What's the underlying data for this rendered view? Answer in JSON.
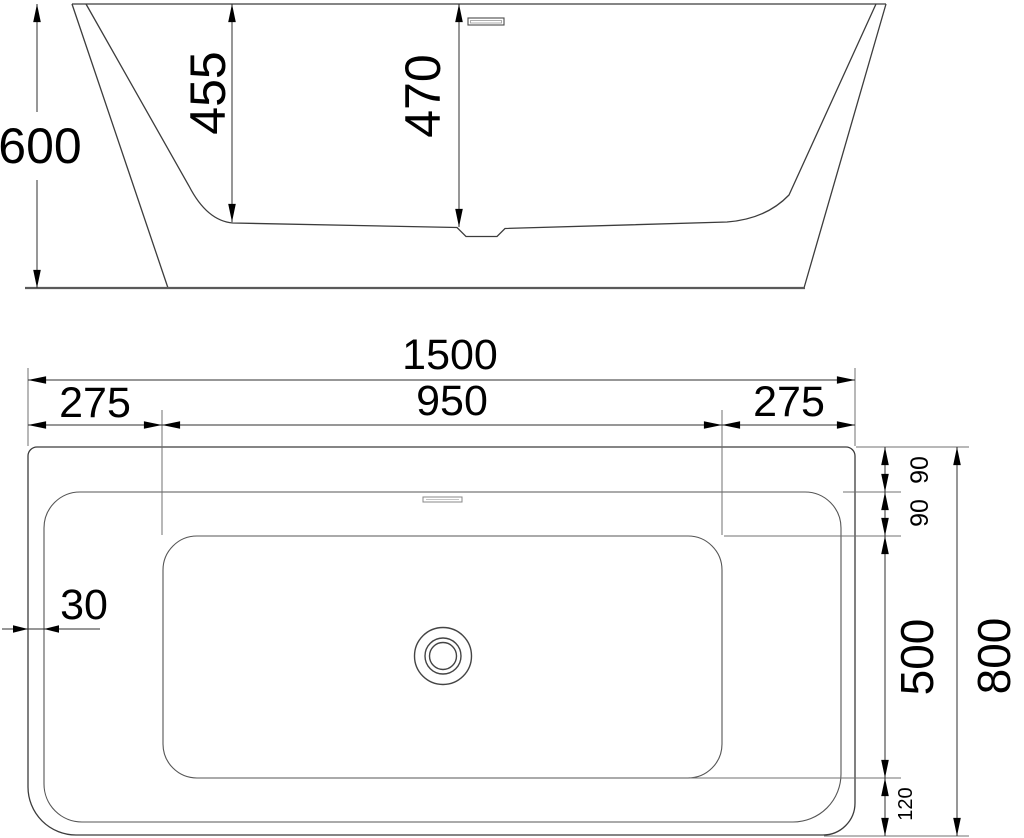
{
  "drawing": {
    "side_view": {
      "total_height": "600",
      "basin_depth": "455",
      "overflow_height": "470"
    },
    "top_view": {
      "total_length": "1500",
      "left_deck": "275",
      "basin_length": "950",
      "right_deck": "275",
      "wall_thickness": "30",
      "rim_band_top": "90",
      "rim_band_inner": "90",
      "basin_width": "500",
      "total_width": "800",
      "bottom_margin": "120"
    }
  }
}
